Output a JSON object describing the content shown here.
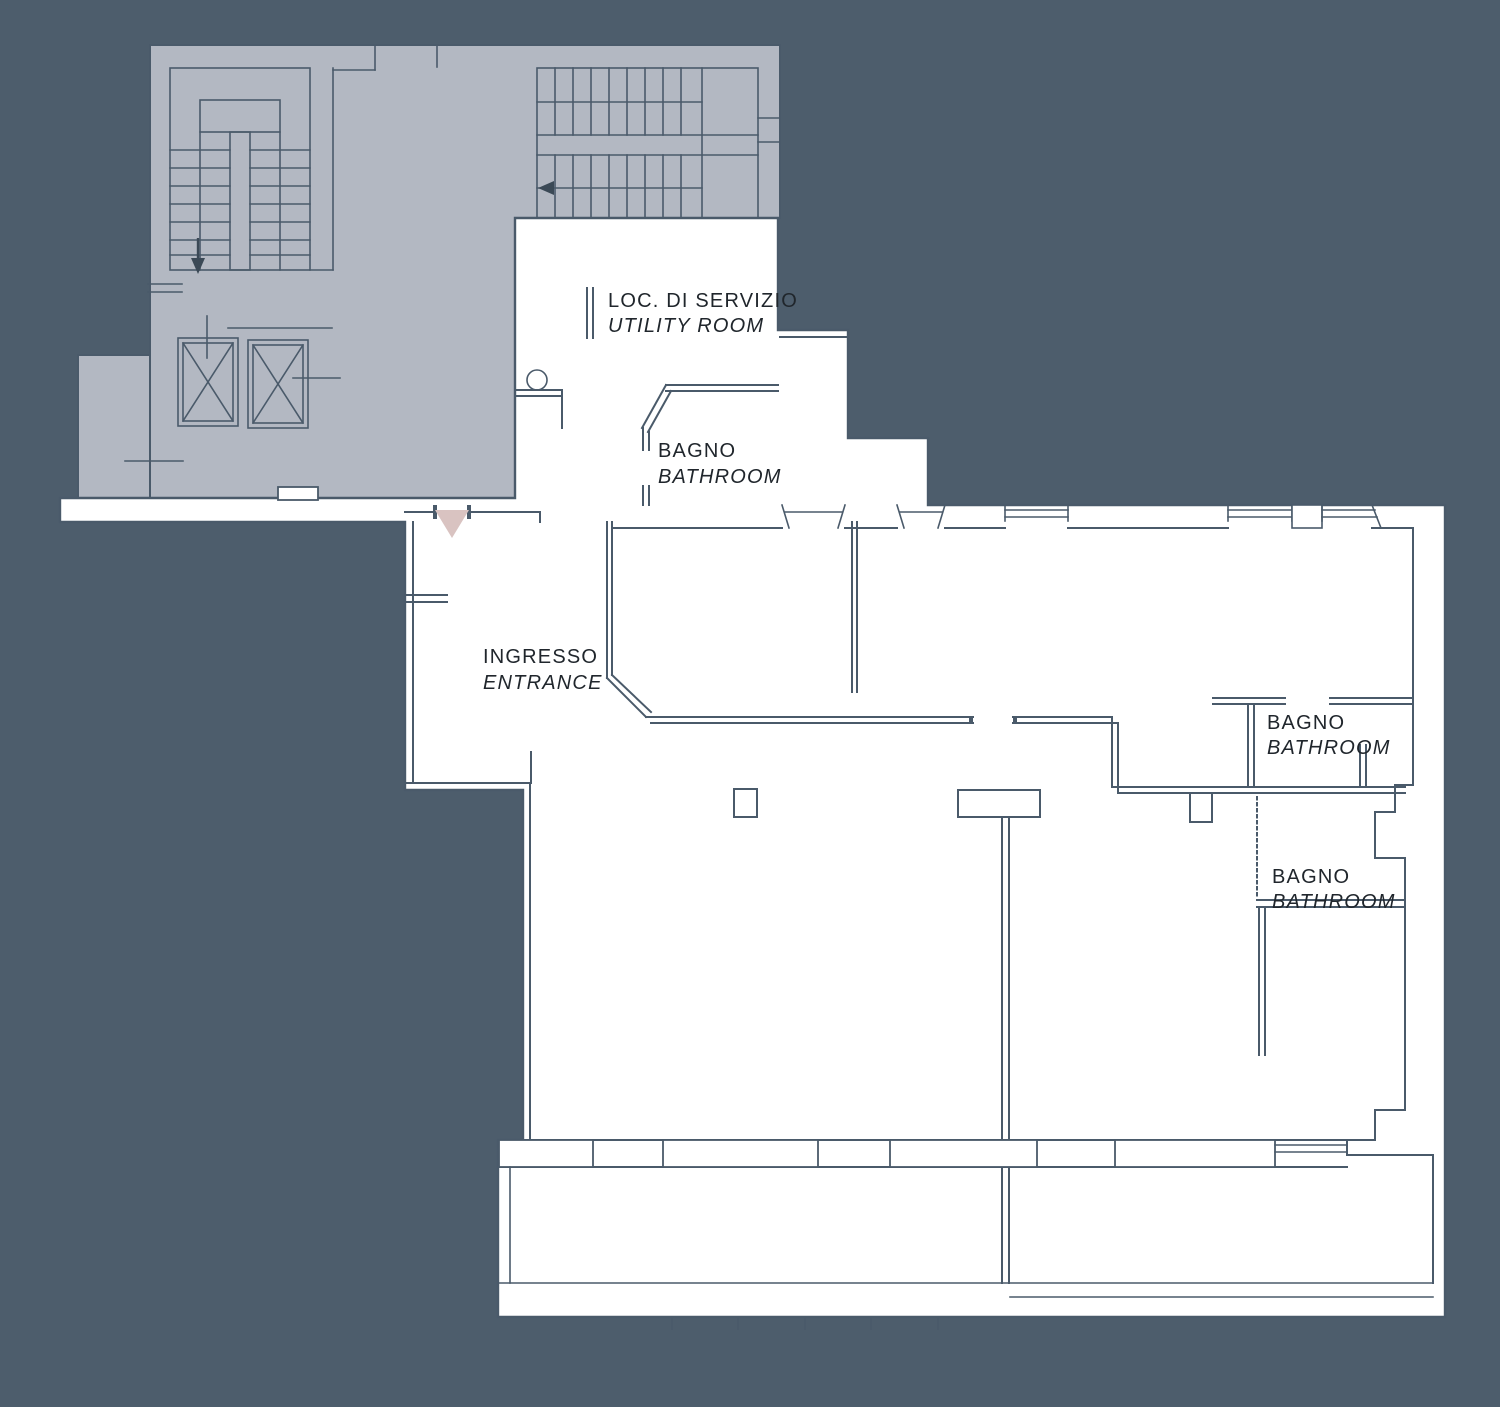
{
  "plan": {
    "rooms": {
      "utility": {
        "label_it": "LOC. DI SERVIZIO",
        "label_en": "UTILITY ROOM"
      },
      "bathroom_top": {
        "label_it": "BAGNO",
        "label_en": "BATHROOM"
      },
      "entrance": {
        "label_it": "INGRESSO",
        "label_en": "ENTRANCE"
      },
      "bathroom_right_upper": {
        "label_it": "BAGNO",
        "label_en": "BATHROOM"
      },
      "bathroom_right_lower": {
        "label_it": "BAGNO",
        "label_en": "BATHROOM"
      }
    },
    "markers": {
      "entrance_marker": "triangle-down-icon",
      "stair_arrow_left_flight": "arrow-down-icon",
      "stair_arrow_top_flight": "arrow-left-icon"
    }
  },
  "colors": {
    "background": "#4d5d6c",
    "common_area": "#b3b8c2",
    "floor": "#ffffff",
    "line": "#4a5a6a",
    "text": "#20262c",
    "accent": "#d9c3c1",
    "arrow": "#3b4956"
  }
}
